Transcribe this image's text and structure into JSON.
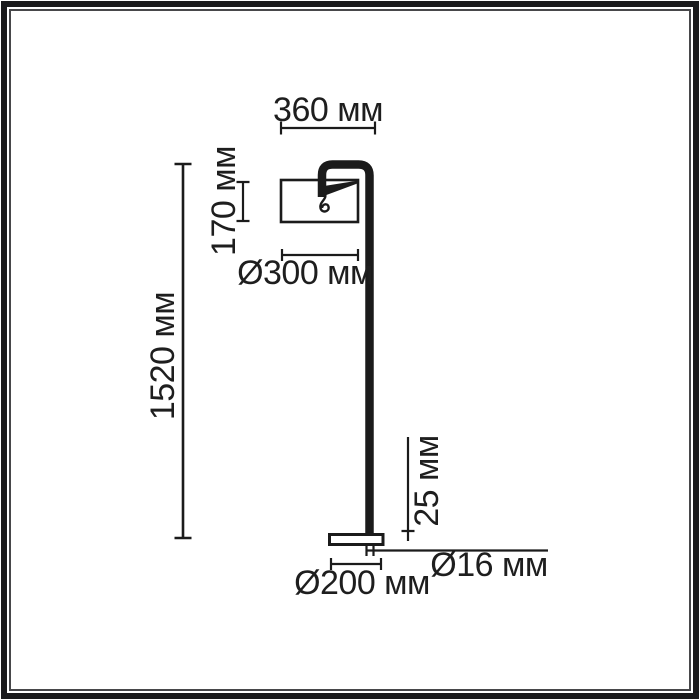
{
  "page": {
    "background": "#ffffff",
    "line_color": "#1b1b1b",
    "frame_color": "#1a1a1c",
    "unit": "мм"
  },
  "drawing": {
    "kind": "floor-lamp dimension drawing",
    "parts": [
      "shade",
      "arm",
      "pole",
      "base",
      "cable-curl"
    ],
    "dimensions": {
      "arm_reach": "360 мм",
      "shade_height": "170 мм",
      "shade_diameter": "Ø300 мм",
      "total_height": "1520 мм",
      "base_thickness": "25 мм",
      "pole_diameter": "Ø16 мм",
      "base_diameter": "Ø200 мм"
    },
    "values_mm": {
      "arm_reach": 360,
      "shade_height": 170,
      "shade_diameter": 300,
      "total_height": 1520,
      "base_thickness": 25,
      "pole_diameter": 16,
      "base_diameter": 200
    }
  }
}
